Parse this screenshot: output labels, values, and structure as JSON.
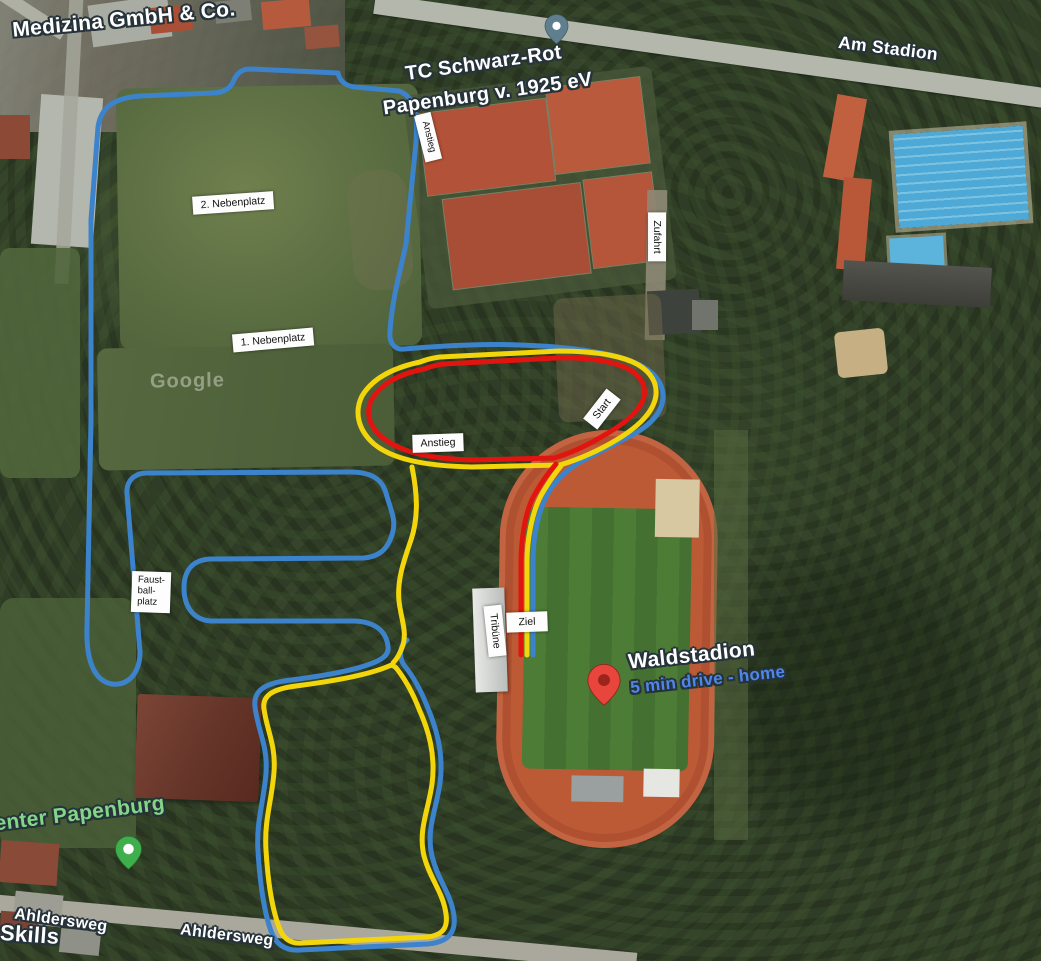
{
  "colors": {
    "route_blue": "#3c83cc",
    "route_yellow": "#f2d60b",
    "route_red": "#e11410",
    "label_blue": "#4e86ec",
    "label_green": "#84d687",
    "pin_red": "#e8453c",
    "pin_red_inner": "#9c241c",
    "pin_green": "#3fae4d",
    "pin_slate": "#5f7e8e",
    "pin_inner_white": "#ffffff"
  },
  "places": {
    "medizina": "Medizina GmbH & Co.",
    "tennis_club_line1": "TC Schwarz-Rot",
    "tennis_club_line2": "Papenburg v. 1925 eV",
    "stadium": "Waldstadion",
    "stadium_note": "5 min drive - home",
    "fitness_center_partial": "enter Papenburg",
    "skills_partial": "Skills",
    "watermark": "Google"
  },
  "roads": {
    "am_stadion": "Am Stadion",
    "ahldersweg_a": "Ahldersweg",
    "ahldersweg_b": "Ahldersweg"
  },
  "course": {
    "nebenplatz2": "2. Nebenplatz",
    "nebenplatz1": "1. Nebenplatz",
    "anstieg_top": "Anstieg",
    "zufahrt": "Zufahrt",
    "start": "Start",
    "anstieg": "Anstieg",
    "faustball": [
      "Faust-",
      "ball-",
      "platz"
    ],
    "tribuene": "Tribüne",
    "ziel": "Ziel"
  }
}
